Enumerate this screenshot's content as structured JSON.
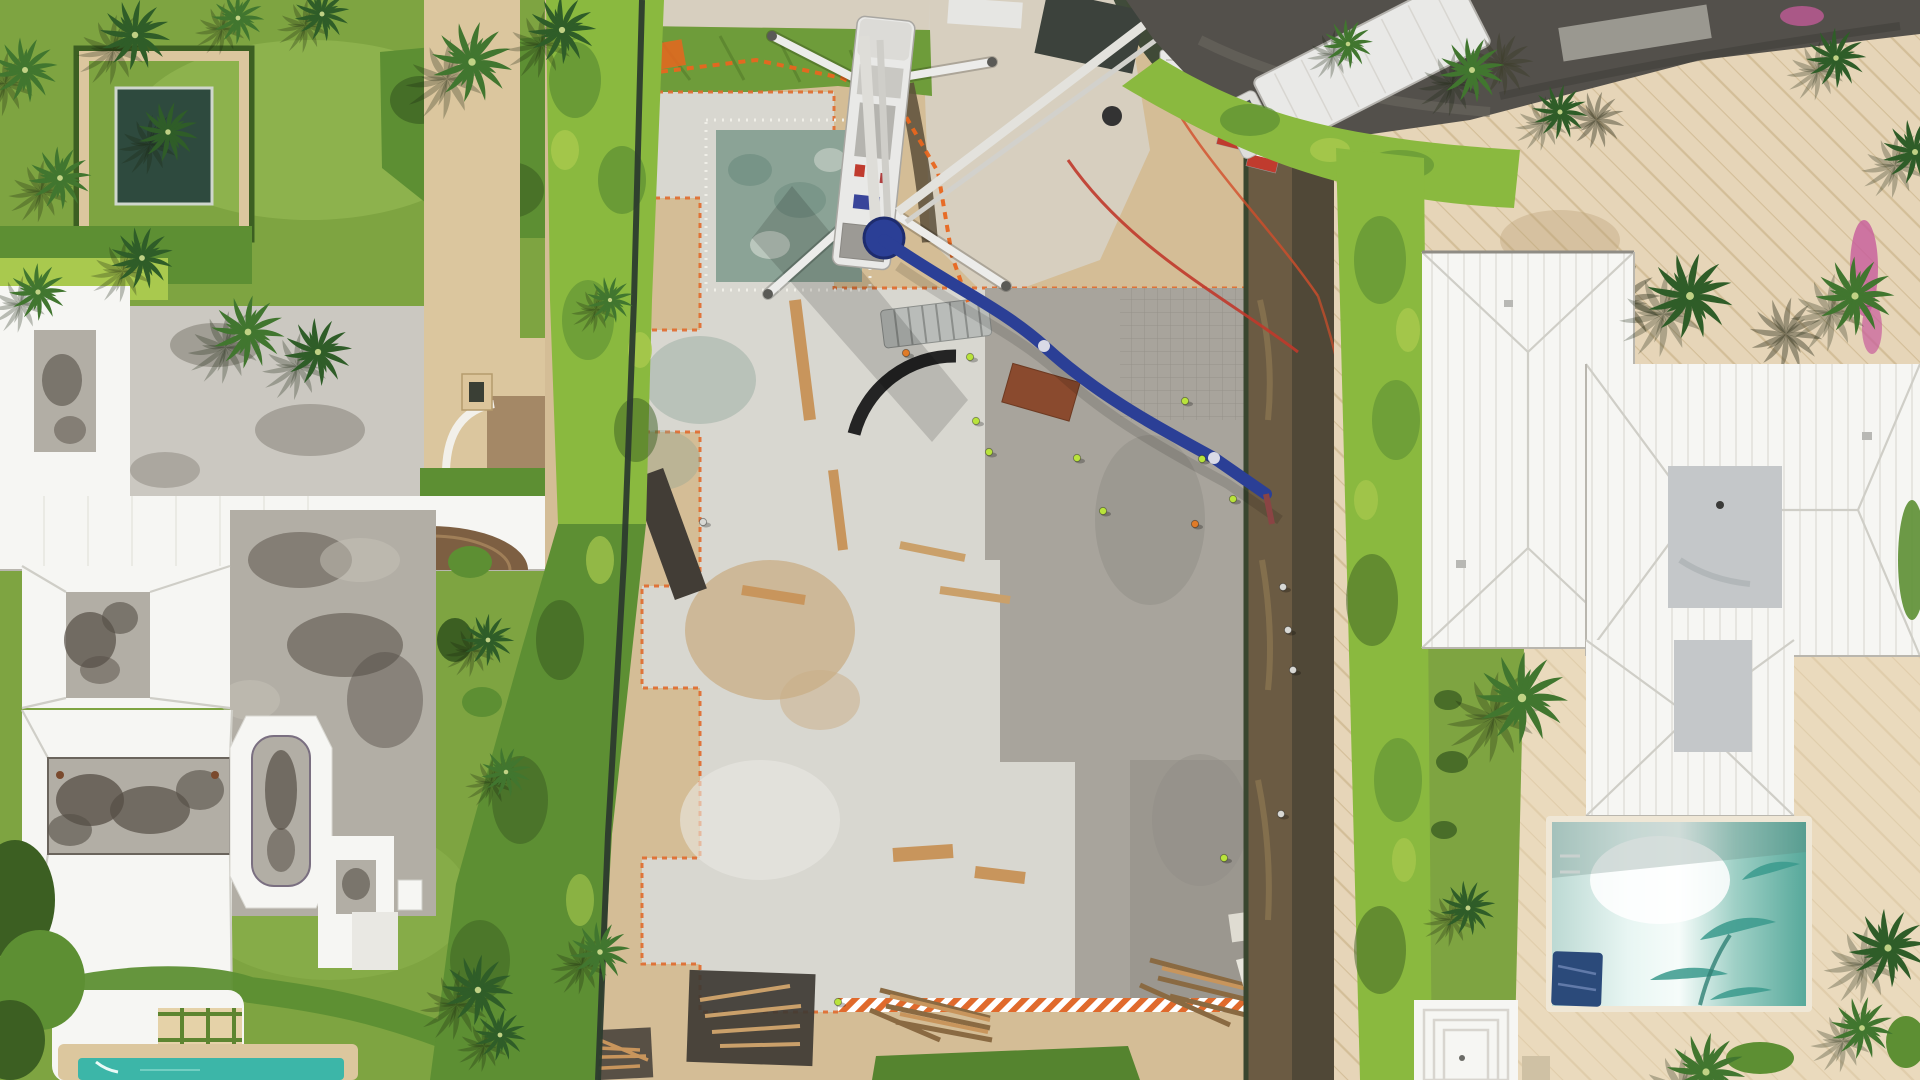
{
  "scene": {
    "colors": {
      "lawn": "#7ea441",
      "lawn_light": "#9abd58",
      "lawn_dark": "#5d8530",
      "hedge": "#5d8f33",
      "hedge_light": "#8ab93f",
      "hedge_lime": "#a9c94e",
      "hedge_dark": "#3c5f22",
      "palm": "#2f5d28",
      "palm_light": "#41762f",
      "sand": "#d4bd96",
      "gravel": "#d7d0c3",
      "sand_dark": "#b89a6e",
      "slab": "#d8d7d0",
      "slab_dark": "#a5a199",
      "footing": "#e9e8e1",
      "slab_teal": "#8ba396",
      "white": "#f6f6f3",
      "roof_shade": "#e9e8e3",
      "roof_line": "#cfcec7",
      "roof_gray": "#c4c7c9",
      "stain_gray": "#b2aea5",
      "stain_dark": "#554e46",
      "tan": "#dbc69e",
      "tan_dark": "#9a7d5c",
      "bronze": "#7d5f42",
      "court_gray": "#cbc8c1",
      "asphalt": "#53504b",
      "truck_white": "#e9e9e7",
      "boom_blue": "#2b3f96",
      "safety_orange": "#e8661f",
      "form_orange": "#e06a2c",
      "hose_red": "#c0392b",
      "equip_red": "#c03b2e",
      "lumber": "#c8955c",
      "plywood": "#3e3933",
      "fence_dark": "#2c3b2e",
      "trench_brown": "#6b5b43",
      "trench_dark": "#33402f",
      "pool_teal": "#3cb6a8",
      "pool_deck": "#dcc79e",
      "pool_r_teal": "#3a9a8d",
      "pool_navy": "#2b4a7a",
      "stone": "#e6d5b8",
      "stone_line": "#d3be98",
      "pink": "#c75b9b",
      "grass_patch": "#55842f",
      "grass_band": "#6e9c3a"
    },
    "left_palms": [
      {
        "x": 25,
        "y": 70,
        "s": 1.25
      },
      {
        "x": 135,
        "y": 35,
        "s": 1.35
      },
      {
        "x": 60,
        "y": 178,
        "s": 1.2
      },
      {
        "x": 168,
        "y": 132,
        "s": 1.15
      },
      {
        "x": 38,
        "y": 292,
        "s": 1.1
      },
      {
        "x": 142,
        "y": 258,
        "s": 1.2
      },
      {
        "x": 238,
        "y": 18,
        "s": 1.0
      },
      {
        "x": 322,
        "y": 14,
        "s": 1.05
      },
      {
        "x": 248,
        "y": 332,
        "s": 1.4
      },
      {
        "x": 318,
        "y": 352,
        "s": 1.3
      },
      {
        "x": 472,
        "y": 62,
        "s": 1.55
      },
      {
        "x": 562,
        "y": 30,
        "s": 1.3
      },
      {
        "x": 610,
        "y": 300,
        "s": 0.9
      },
      {
        "x": 488,
        "y": 640,
        "s": 1.0
      },
      {
        "x": 506,
        "y": 772,
        "s": 0.95
      },
      {
        "x": 478,
        "y": 990,
        "s": 1.35
      },
      {
        "x": 600,
        "y": 952,
        "s": 1.15
      },
      {
        "x": 500,
        "y": 1035,
        "s": 1.0
      }
    ],
    "right_palms": [
      {
        "x": 1472,
        "y": 70,
        "s": 1.25
      },
      {
        "x": 1560,
        "y": 112,
        "s": 1.05
      },
      {
        "x": 1348,
        "y": 44,
        "s": 0.95
      },
      {
        "x": 1690,
        "y": 296,
        "s": 1.65
      },
      {
        "x": 1855,
        "y": 296,
        "s": 1.5
      },
      {
        "x": 1915,
        "y": 152,
        "s": 1.25
      },
      {
        "x": 1522,
        "y": 698,
        "s": 1.75
      },
      {
        "x": 1468,
        "y": 908,
        "s": 1.05
      },
      {
        "x": 1706,
        "y": 1072,
        "s": 1.5
      },
      {
        "x": 1888,
        "y": 948,
        "s": 1.5
      },
      {
        "x": 1862,
        "y": 1028,
        "s": 1.2
      },
      {
        "x": 1836,
        "y": 58,
        "s": 1.15
      }
    ],
    "shadow_palms": [
      {
        "x": 1622,
        "y": 302,
        "s": 1.5
      },
      {
        "x": 1786,
        "y": 334,
        "s": 1.4
      },
      {
        "x": 1502,
        "y": 64,
        "s": 1.2
      },
      {
        "x": 1596,
        "y": 120,
        "s": 1.1
      }
    ],
    "workers": [
      {
        "x": 970,
        "y": 357,
        "c": "#b9e33c"
      },
      {
        "x": 976,
        "y": 421,
        "c": "#b9e33c"
      },
      {
        "x": 989,
        "y": 452,
        "c": "#b9e33c"
      },
      {
        "x": 1077,
        "y": 458,
        "c": "#b9e33c"
      },
      {
        "x": 1103,
        "y": 511,
        "c": "#b9e33c"
      },
      {
        "x": 1185,
        "y": 401,
        "c": "#b9e33c"
      },
      {
        "x": 1202,
        "y": 459,
        "c": "#b9e33c"
      },
      {
        "x": 1233,
        "y": 499,
        "c": "#b9e33c"
      },
      {
        "x": 1224,
        "y": 858,
        "c": "#b9e33c"
      },
      {
        "x": 1170,
        "y": 40,
        "c": "#b9e33c"
      },
      {
        "x": 838,
        "y": 1002,
        "c": "#b9e33c"
      },
      {
        "x": 1195,
        "y": 524,
        "c": "#e07b28"
      },
      {
        "x": 906,
        "y": 353,
        "c": "#e07b28"
      },
      {
        "x": 703,
        "y": 522,
        "c": "#d8d8d4"
      },
      {
        "x": 1283,
        "y": 587,
        "c": "#d8d8d4"
      },
      {
        "x": 1288,
        "y": 630,
        "c": "#d8d8d4"
      },
      {
        "x": 1293,
        "y": 670,
        "c": "#d8d8d4"
      },
      {
        "x": 1281,
        "y": 814,
        "c": "#d8d8d4"
      }
    ],
    "stepping_stones": [
      [
        10,
        311
      ],
      [
        32,
        317
      ],
      [
        54,
        324
      ],
      [
        76,
        332
      ],
      [
        98,
        340
      ],
      [
        120,
        347
      ],
      [
        142,
        353
      ],
      [
        164,
        358
      ],
      [
        186,
        361
      ]
    ]
  }
}
